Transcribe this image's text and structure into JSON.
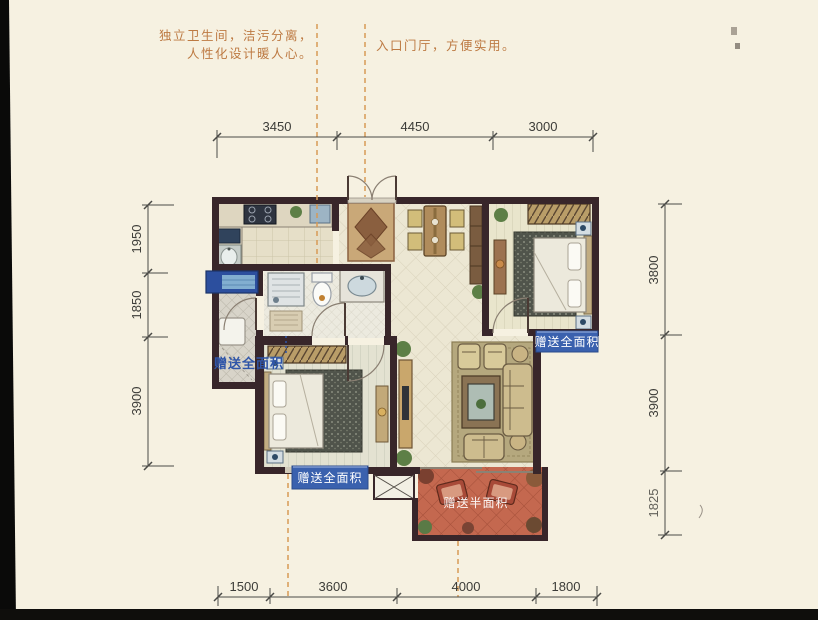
{
  "notes": {
    "left_line1": "独立卫生间，洁污分离，",
    "left_line2": "人性化设计暖人心。",
    "right": "入口门厅，方便实用。"
  },
  "labels": {
    "gift_full_left": "赠送全面积",
    "gift_full_right": "赠送全面积",
    "gift_full_bottom": "赠送全面积",
    "gift_half_terrace": "赠送半面积"
  },
  "dims": {
    "top": [
      "3450",
      "4450",
      "3000"
    ],
    "left": [
      "1950",
      "1850",
      "3900"
    ],
    "right": [
      "3800",
      "3900",
      "1825"
    ],
    "bottom": [
      "1500",
      "3600",
      "4000",
      "1800"
    ]
  },
  "colors": {
    "page_bg": "#f6f1e1",
    "wall": "#38262a",
    "label_blue_bg": "#3a61ae",
    "label_blue_text": "#2f55a8",
    "note_orange": "#bd7a43",
    "terrace_red": "#c4684f",
    "window_blue": "#2c4f9e",
    "dim_text": "#3c3c38"
  }
}
